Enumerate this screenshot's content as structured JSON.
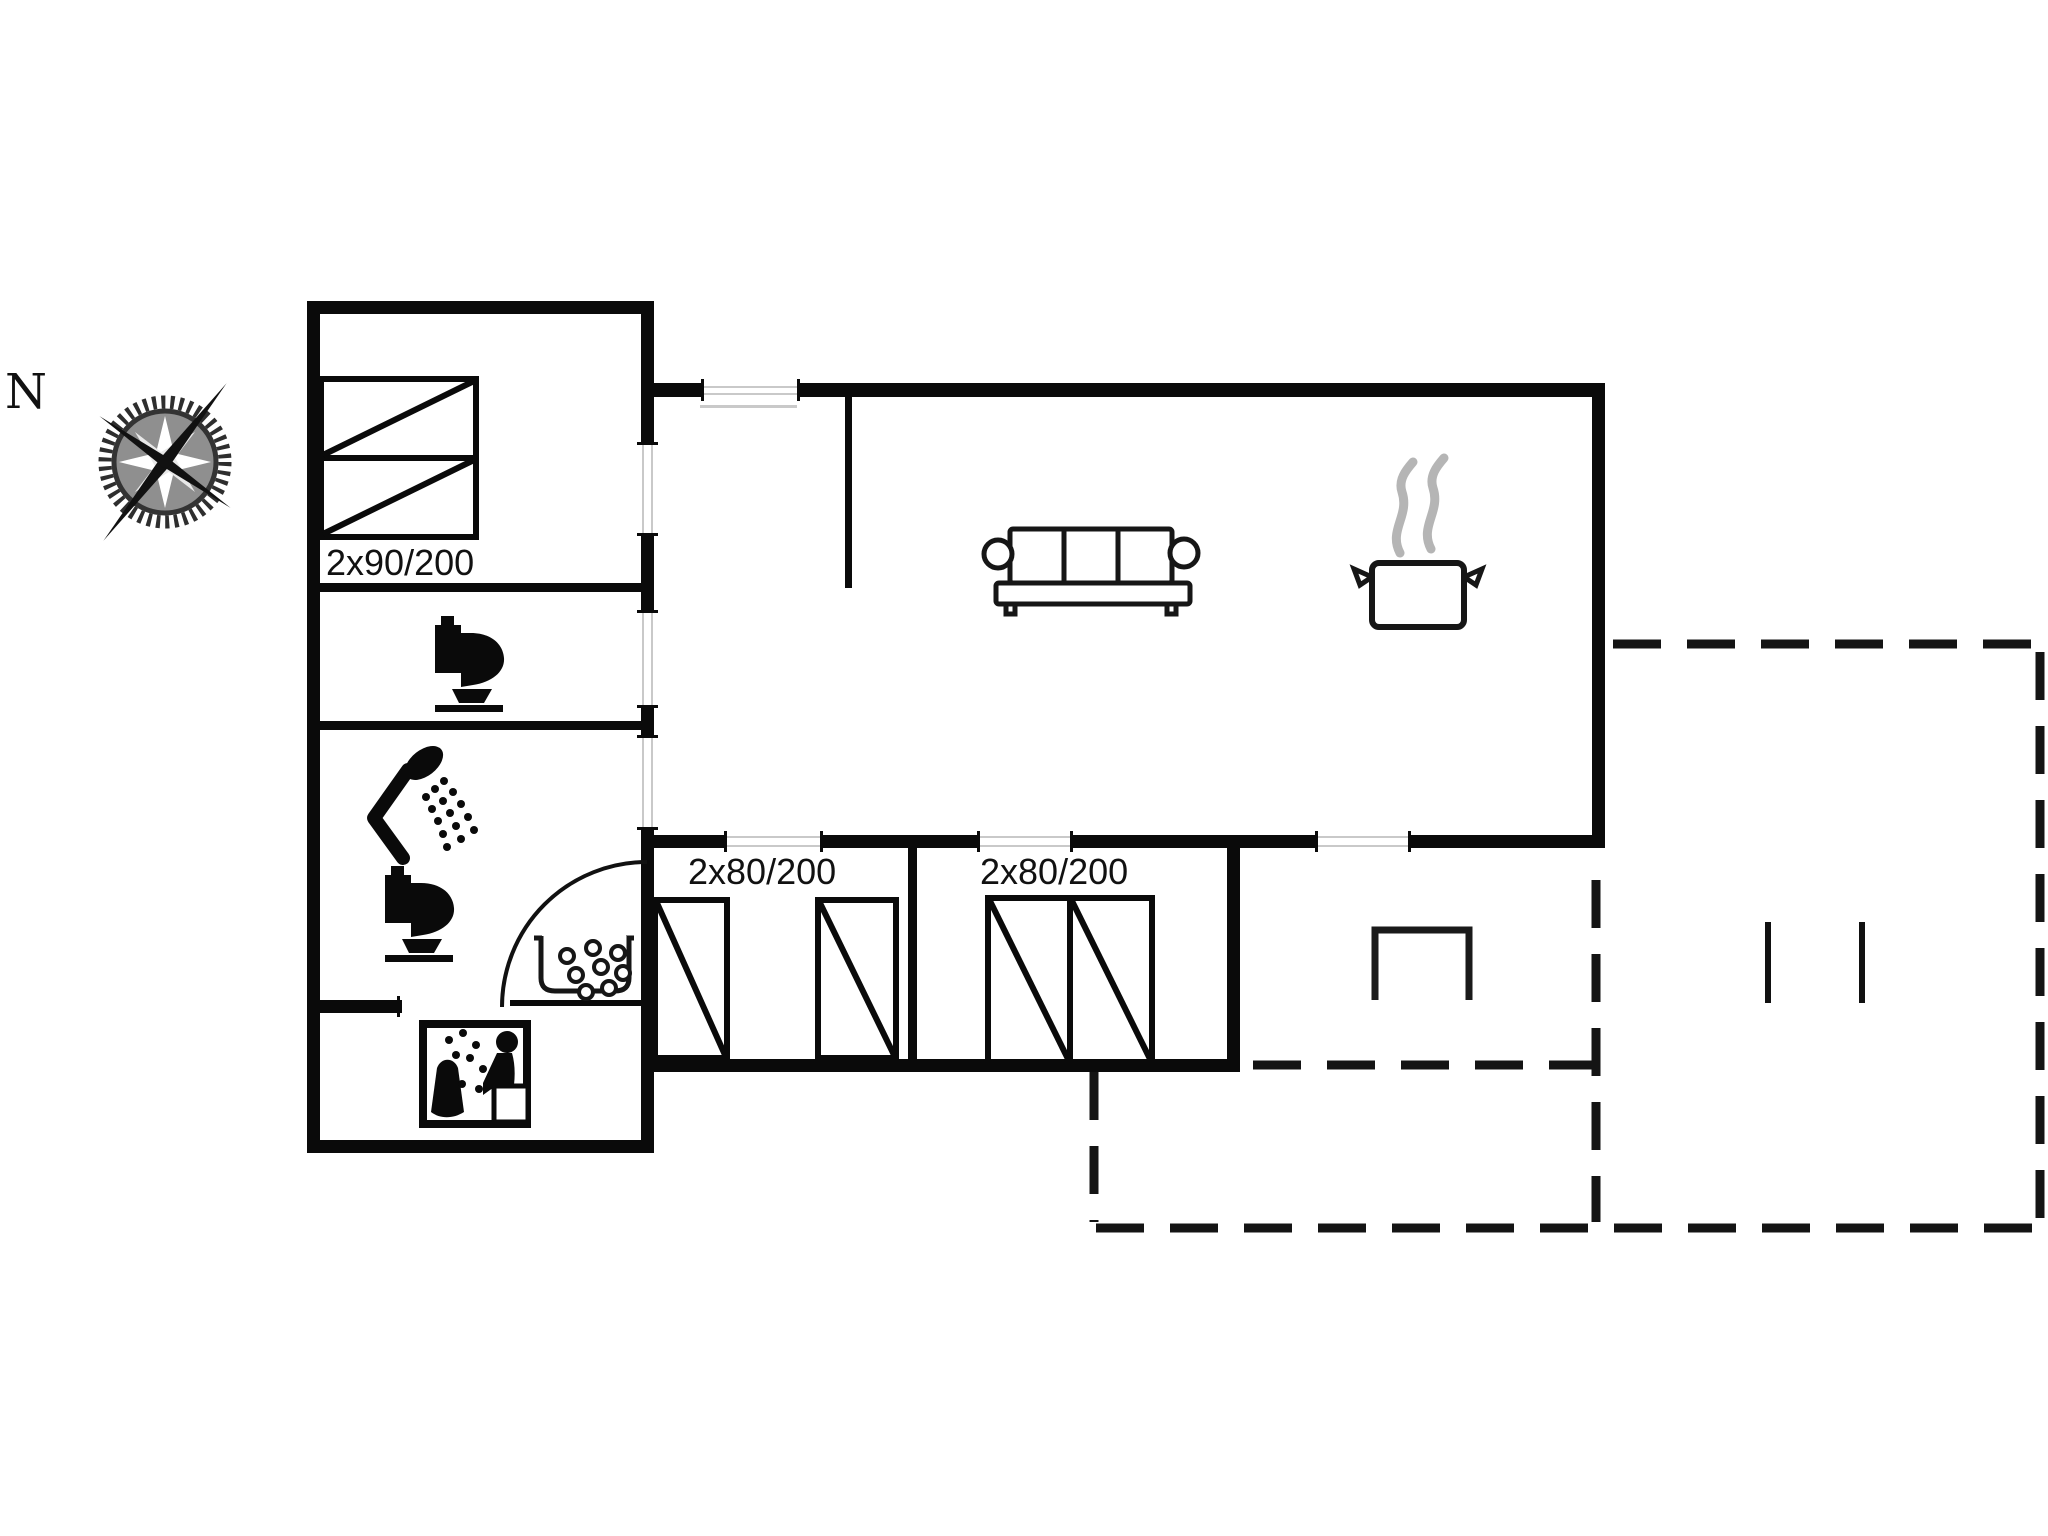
{
  "plan": {
    "type": "floor-plan",
    "north_label": "N",
    "master_bedroom": {
      "bed_label": "2x90/200"
    },
    "bedroom_1": {
      "bed_label": "2x80/200"
    },
    "bedroom_2": {
      "bed_label": "2x80/200"
    },
    "fixtures": [
      "compass-rose",
      "double-bed",
      "toilet",
      "shower",
      "toilet",
      "washbasin",
      "sauna",
      "sofa",
      "cooking-pot",
      "terrace-table",
      "terrace-bench"
    ],
    "colors": {
      "wall": "#0a0a0a",
      "furniture_line": "#161616",
      "steam_gray": "#b5b5b5",
      "threshold_gray": "#c9c9c9",
      "label_text": "#111111",
      "background": "#ffffff"
    }
  }
}
